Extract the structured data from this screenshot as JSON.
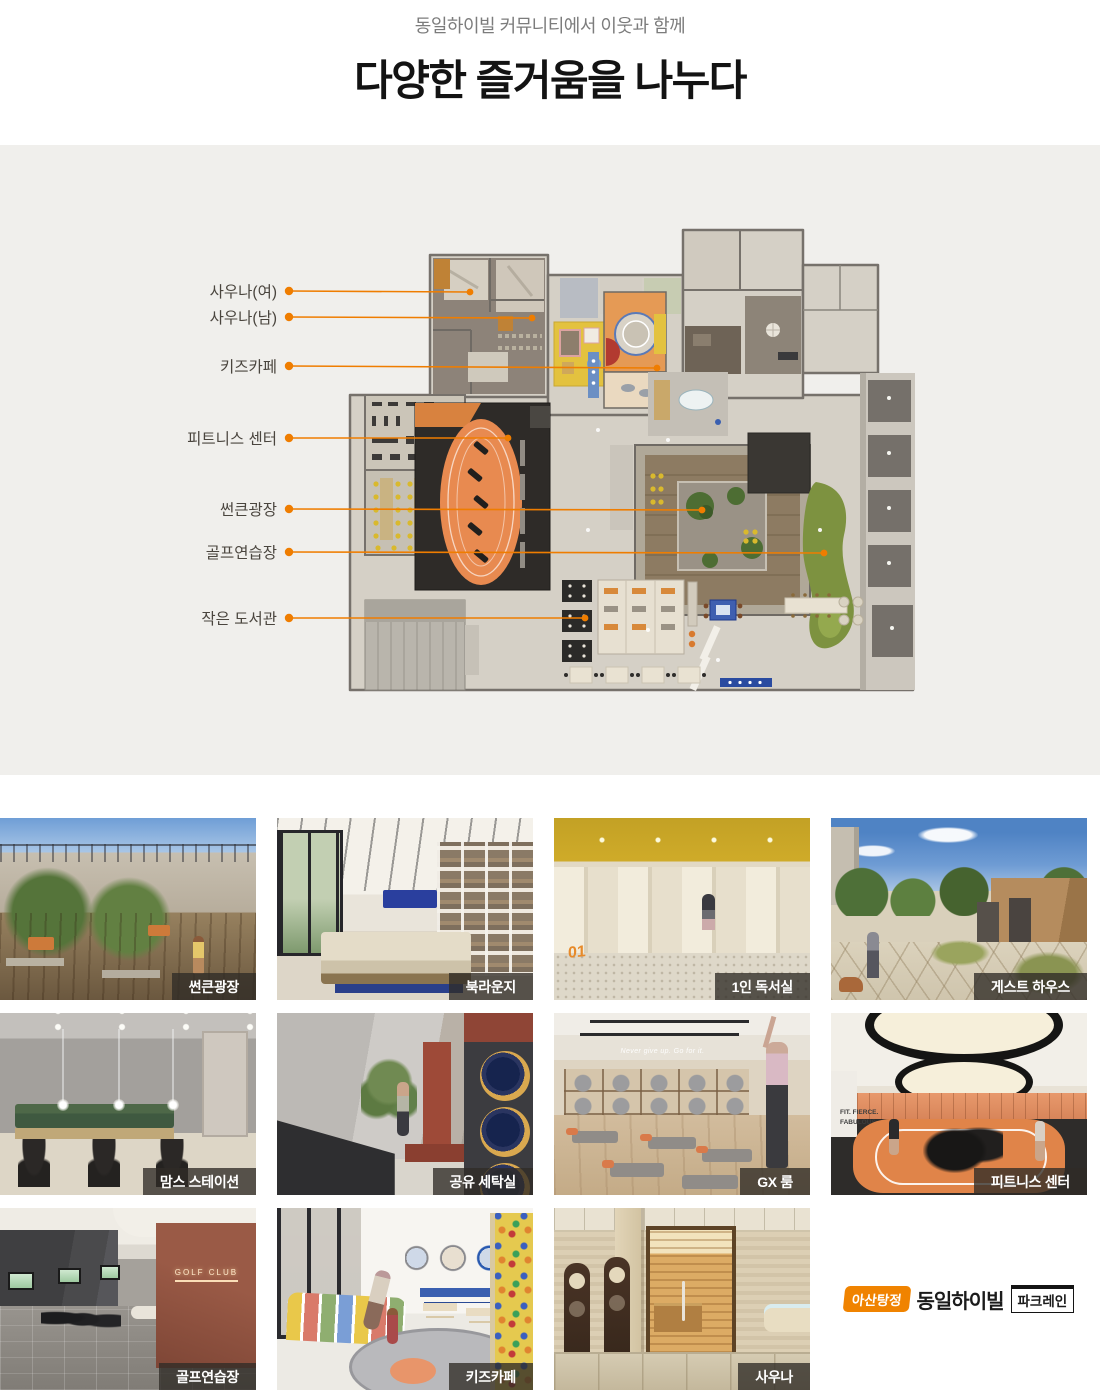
{
  "header": {
    "subtitle": "동일하이빌 커뮤니티에서 이웃과 함께",
    "title": "다양한 즐거움을 나누다"
  },
  "plan": {
    "accent": "#ef7d00",
    "labels": [
      {
        "text": "사우나(여)"
      },
      {
        "text": "사우나(남)"
      },
      {
        "text": "키즈카페"
      },
      {
        "text": "피트니스 센터"
      },
      {
        "text": "썬큰광장"
      },
      {
        "text": "골프연습장"
      },
      {
        "text": "작은 도서관"
      }
    ]
  },
  "gallery": {
    "items": [
      {
        "label": "썬큰광장"
      },
      {
        "label": "북라운지"
      },
      {
        "label": "1인 독서실",
        "door_number": "01"
      },
      {
        "label": "게스트 하우스"
      },
      {
        "label": "맘스 스테이션"
      },
      {
        "label": "공유 세탁실"
      },
      {
        "label": "GX 룸",
        "wall_text": "Never give up. Go for it."
      },
      {
        "label": "피트니스 센터",
        "wall_text": "FIT. FIERCE. FABULOUS."
      },
      {
        "label": "골프연습장",
        "sign_text": "GOLF CLUB"
      },
      {
        "label": "키즈카페"
      },
      {
        "label": "사우나"
      }
    ]
  },
  "logo": {
    "badge": "아산탕정",
    "brand": "동일하이빌",
    "sub": "파크레인"
  },
  "colors": {
    "accent_orange": "#ef7d00",
    "section_bg": "#f0efec",
    "caption_bg": "rgba(48,44,39,0.78)"
  }
}
